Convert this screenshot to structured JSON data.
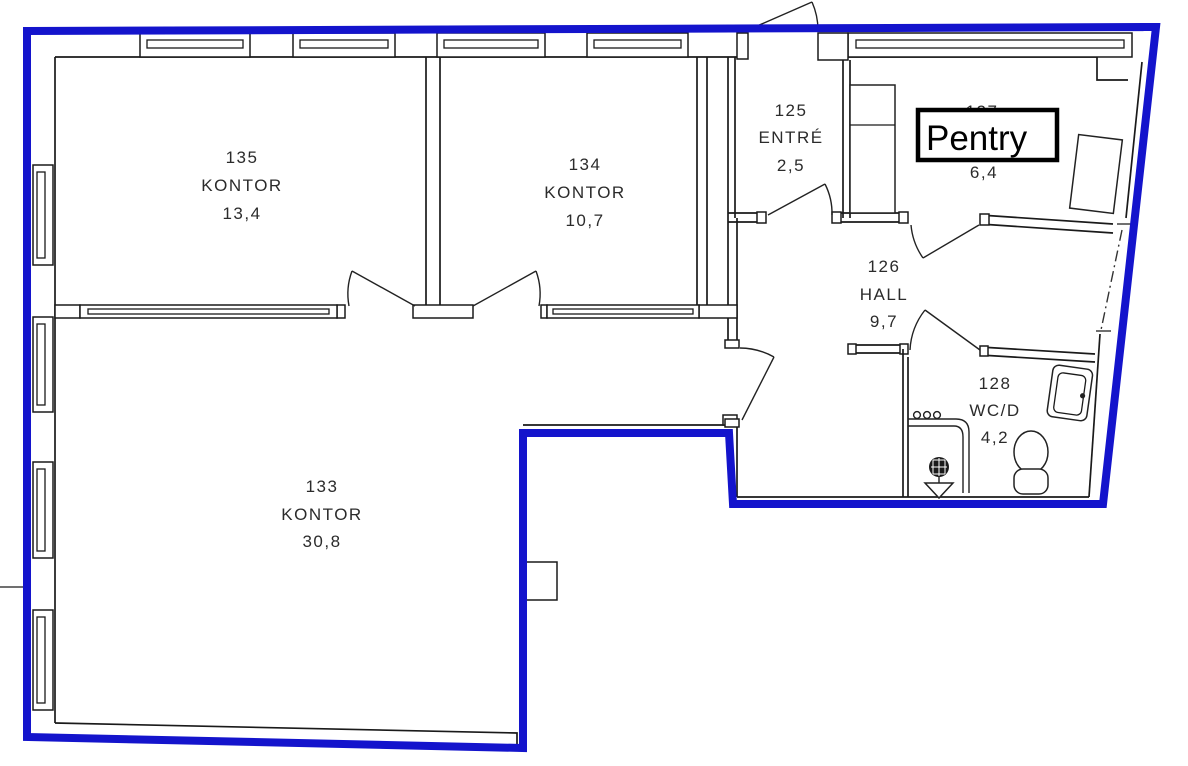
{
  "rooms": [
    {
      "number": "135",
      "name": "KONTOR",
      "area": "13,4"
    },
    {
      "number": "134",
      "name": "KONTOR",
      "area": "10,7"
    },
    {
      "number": "125",
      "name": "ENTRÉ",
      "area": "2,5"
    },
    {
      "number": "127",
      "name": "Pentry",
      "area": "6,4"
    },
    {
      "number": "126",
      "name": "HALL",
      "area": "9,7"
    },
    {
      "number": "128",
      "name": "WC/D",
      "area": "4,2"
    },
    {
      "number": "133",
      "name": "KONTOR",
      "area": "30,8"
    }
  ],
  "colors": {
    "boundary": "#1414cc",
    "wall": "#1a1a1a"
  }
}
